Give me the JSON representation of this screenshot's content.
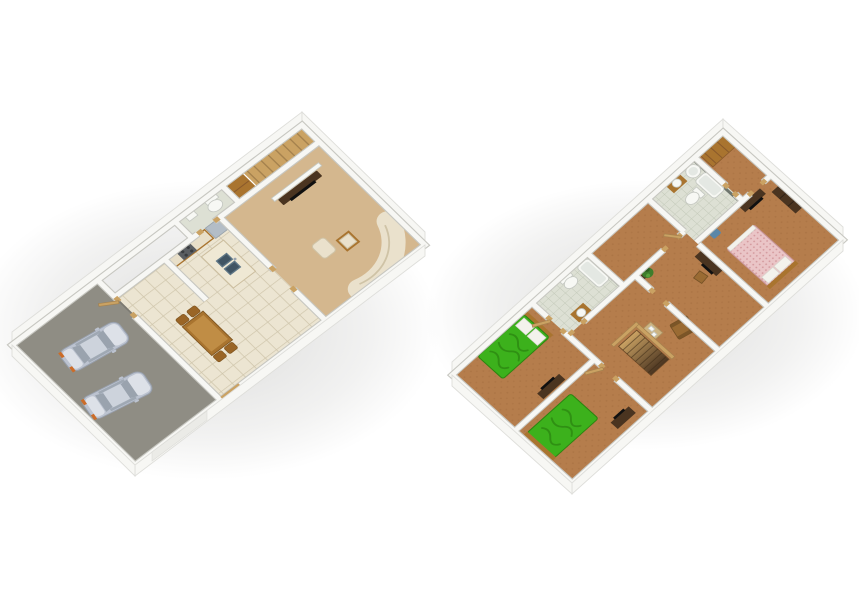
{
  "meta": {
    "description": "Two 3D isometric dollhouse-style floor plan renders on a plain white background",
    "left_plan_label": "ground-floor-plan",
    "right_plan_label": "upper-floor-plan"
  },
  "colors": {
    "wall": "#f7f7f4",
    "wall_edge": "#c7c7c1",
    "band_edge": "#dededa",
    "floor_tan": "#d4b78e",
    "floor_tile": "#ece5d2",
    "tile_line": "#cfc5ab",
    "floor_brown": "#b57d4c",
    "carpet_dot": "#a06a3c",
    "floor_garage": "#8f8d84",
    "garage_edge": "#7c7a72",
    "floor_bath": "#dde0d4",
    "bath_line": "#c2c8b8",
    "bath_wall": "#646b64",
    "wood": "#a9742f",
    "wood_dark": "#4a3420",
    "wood_light": "#caa263",
    "stair_line": "#a5824e",
    "bed_green": "#3cb11c",
    "bed_green_dark": "#2b8510",
    "bed_pink": "#eac5c7",
    "bed_pink_dark": "#d49a9e",
    "pillow": "#f3f2ec",
    "fixture_white": "#f7f8f4",
    "fixture_inner": "#e4e8e3",
    "fixture_edge": "#c5c8c2",
    "sofa": "#eae1cc",
    "sofa_shadow": "#cfc3a6",
    "car_body": "#bcc3d0",
    "car_glass": "#9aa3ae",
    "car_light": "#dde1e8",
    "taillight": "#cc6c28",
    "glass_blue": "#b8cdd4",
    "glass_pale": "#e9eef0",
    "window_frame": "#cfc77e",
    "plant": "#3f7d2c",
    "plant_dark": "#2e5c20",
    "plant_light": "#57a03a",
    "tv_black": "#101010",
    "fridge": "#b3bdc6",
    "stove": "#5a5e62",
    "sink": "#5d7585",
    "sink_dark": "#405463",
    "hamper": "#5b87a8",
    "table_light": "#cdb483",
    "chair": "#9a6b33",
    "chair_dark": "#755126",
    "shadow": "#787873"
  },
  "scene": {
    "plans": [
      {
        "id": "ground-floor-plan",
        "rooms": [
          {
            "name": "living-room",
            "furniture": [
              "curved-sofa",
              "tv-unit",
              "coffee-table",
              "ottoman",
              "windows"
            ]
          },
          {
            "name": "kitchen",
            "furniture": [
              "island-with-double-sink",
              "counter",
              "fridge",
              "stove"
            ]
          },
          {
            "name": "dining-area",
            "furniture": [
              "dining-table",
              "chairs",
              "entry-door"
            ]
          },
          {
            "name": "staircase",
            "furniture": [
              "stairs"
            ]
          },
          {
            "name": "closet",
            "furniture": [
              "wardrobe"
            ]
          },
          {
            "name": "powder-room",
            "furniture": [
              "toilet",
              "sink"
            ]
          },
          {
            "name": "garage",
            "furniture": [
              "car",
              "car",
              "garage-door"
            ]
          }
        ]
      },
      {
        "id": "upper-floor-plan",
        "rooms": [
          {
            "name": "master-bedroom",
            "furniture": [
              "double-bed-pink",
              "tv-dresser",
              "wardrobe",
              "hamper",
              "windows"
            ]
          },
          {
            "name": "master-bathroom",
            "furniture": [
              "bathtub",
              "toilet",
              "sink",
              "water-heater"
            ]
          },
          {
            "name": "hall-closet",
            "furniture": [
              "shelving"
            ]
          },
          {
            "name": "study-bedroom",
            "furniture": [
              "tv-desk",
              "chair",
              "plant"
            ]
          },
          {
            "name": "hallway",
            "furniture": [
              "armchair",
              "side-table",
              "stair-railing",
              "stairwell"
            ]
          },
          {
            "name": "main-bathroom",
            "furniture": [
              "bathtub",
              "toilet",
              "sink-cabinet"
            ]
          },
          {
            "name": "bedroom-2",
            "furniture": [
              "double-bed-green",
              "pillows",
              "tv-dresser"
            ]
          },
          {
            "name": "bedroom-3",
            "furniture": [
              "double-bed-green",
              "dresser"
            ]
          }
        ]
      }
    ]
  }
}
